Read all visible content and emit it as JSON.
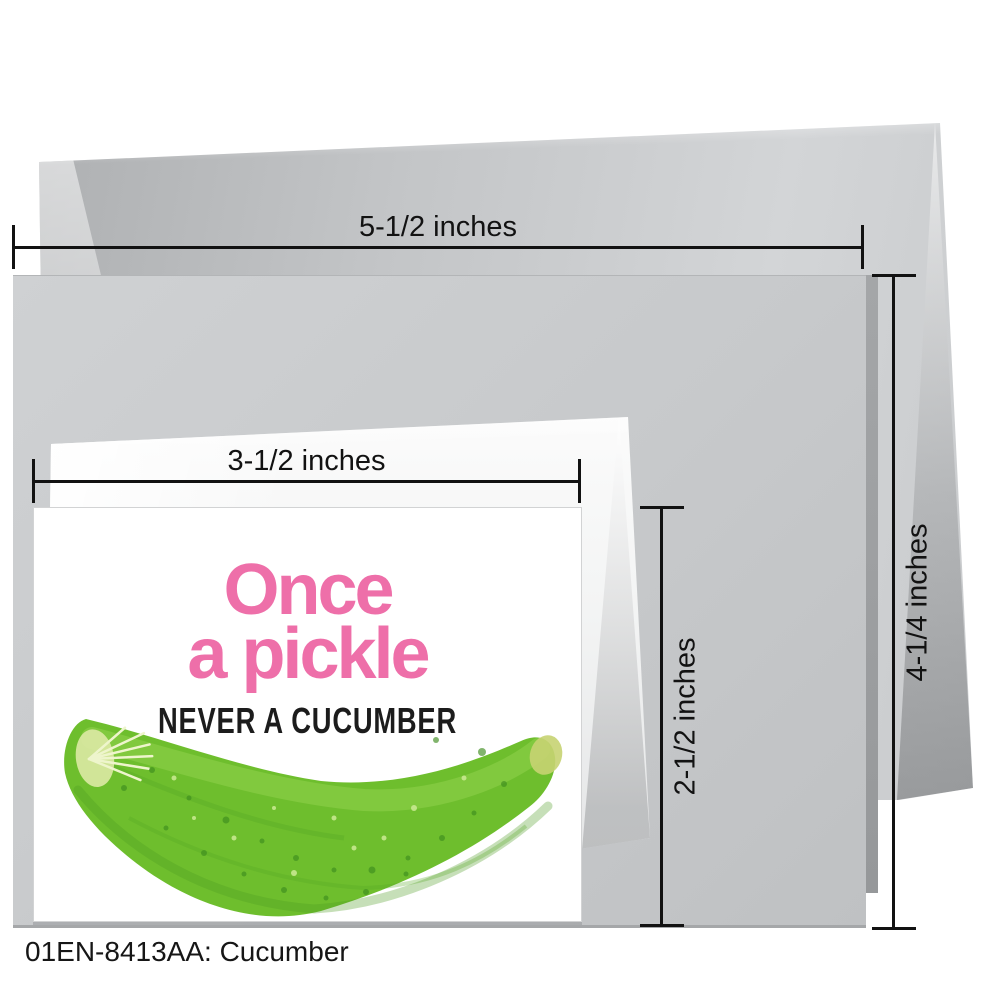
{
  "product": {
    "caption": "01EN-8413AA: Cucumber"
  },
  "artwork": {
    "title_line1": "Once",
    "title_line2": "a pickle",
    "subtitle": "NEVER A CUCUMBER"
  },
  "measurements": {
    "envelope_width": "5-1/2 inches",
    "card_small_width": "3-1/2 inches",
    "card_small_height": "2-1/2 inches",
    "card_large_height": "4-1/4 inches"
  },
  "colors": {
    "pink": "#ee6fa9",
    "green": "#6ebe2d",
    "green_dark": "#3e8d1f",
    "green_light": "#93d44f",
    "ink": "#141414"
  }
}
